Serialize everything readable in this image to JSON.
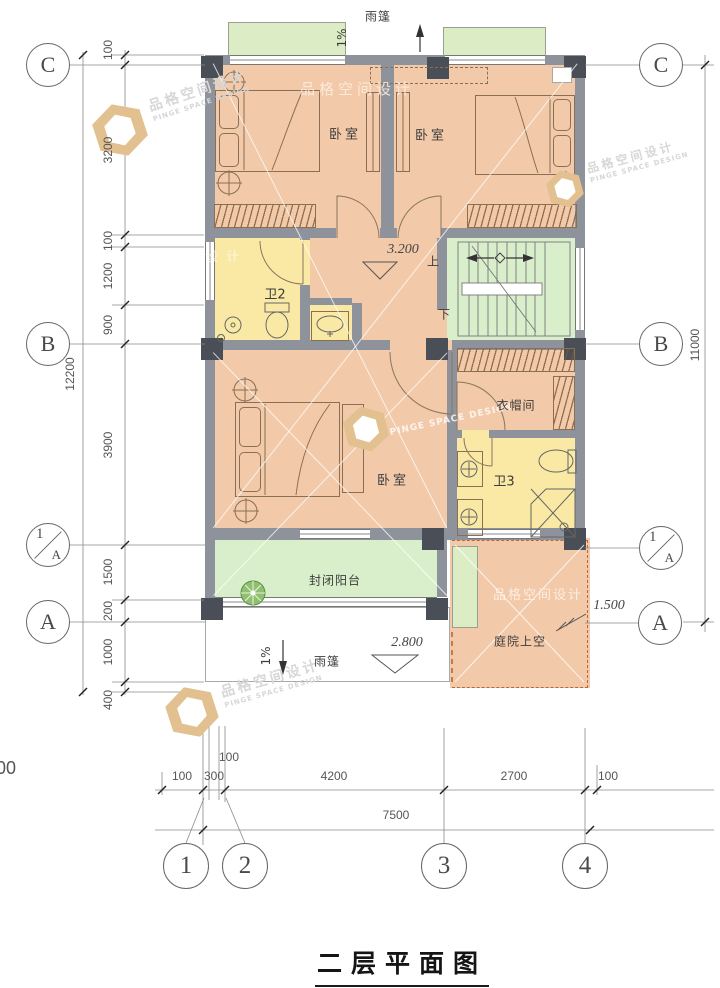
{
  "title": "二层平面图",
  "watermark": {
    "cn": "品格空间设计",
    "en": "PINGE SPACE DESIGN",
    "short": "设 计"
  },
  "grid": {
    "rows": [
      {
        "label": "C"
      },
      {
        "label": "B"
      },
      {
        "num": "1",
        "letter": "A"
      },
      {
        "label": "A"
      }
    ],
    "cols": [
      {
        "label": "1"
      },
      {
        "label": "2"
      },
      {
        "label": "3"
      },
      {
        "label": "4"
      }
    ]
  },
  "dims": {
    "left_chain": [
      "100",
      "3200",
      "100",
      "1200",
      "900",
      "3900",
      "1500",
      "200",
      "1000",
      "400"
    ],
    "left_total": "12200",
    "right_total": "11000",
    "bottom_chain": [
      "100",
      "300",
      "100",
      "4200",
      "2700",
      "100"
    ],
    "bottom_total": "7500",
    "edge_partial": "00"
  },
  "levels": {
    "floor": "3.200",
    "canopy": "2.800",
    "yard": "1.500"
  },
  "labels": {
    "bedroom": "卧室",
    "bath2": "卫2",
    "bath3": "卫3",
    "cloakroom": "衣帽间",
    "balcony": "封闭阳台",
    "courtyard": "庭院上空",
    "canopy": "雨篷",
    "slope": "1%",
    "up": "上",
    "down": "下"
  },
  "colors": {
    "wall": "#8e939b",
    "column": "#4a4f57",
    "room": "#f2c9a9",
    "bath": "#f9e9a4",
    "stair_green": "#d9efcc",
    "canopy_green": "#dcedc6",
    "courtyard_border": "#b4683c"
  }
}
